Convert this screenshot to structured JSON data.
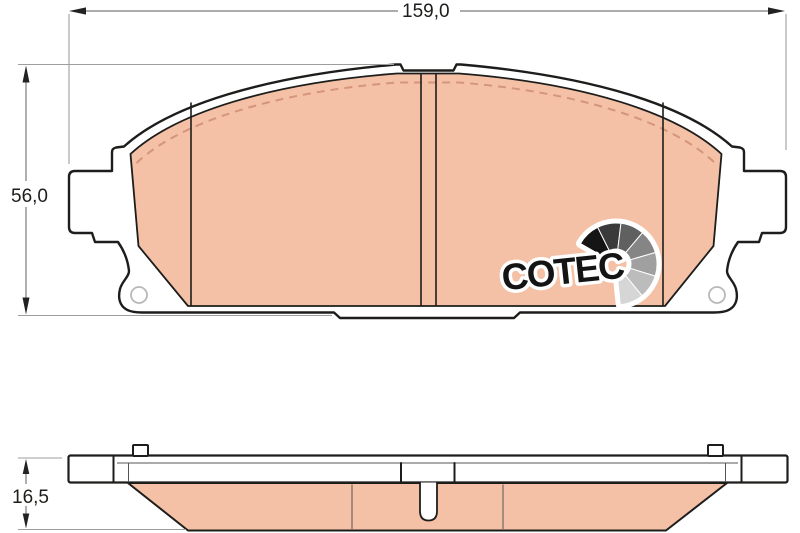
{
  "drawing": {
    "dimensions": {
      "width": "159,0",
      "height": "56,0",
      "thickness": "16,5"
    },
    "logo": {
      "text": "COTEC",
      "fan_colors": [
        "#151515",
        "#3a3a3a",
        "#606060",
        "#858585",
        "#a0a0a0",
        "#bcbcbc",
        "#d6d6d6"
      ]
    },
    "colors": {
      "friction_material": "#f4c1a6",
      "friction_dash": "#d4957b",
      "outline": "#1d1d1b",
      "backplate": "#ffffff",
      "extension_line": "#9e9e9e"
    }
  }
}
